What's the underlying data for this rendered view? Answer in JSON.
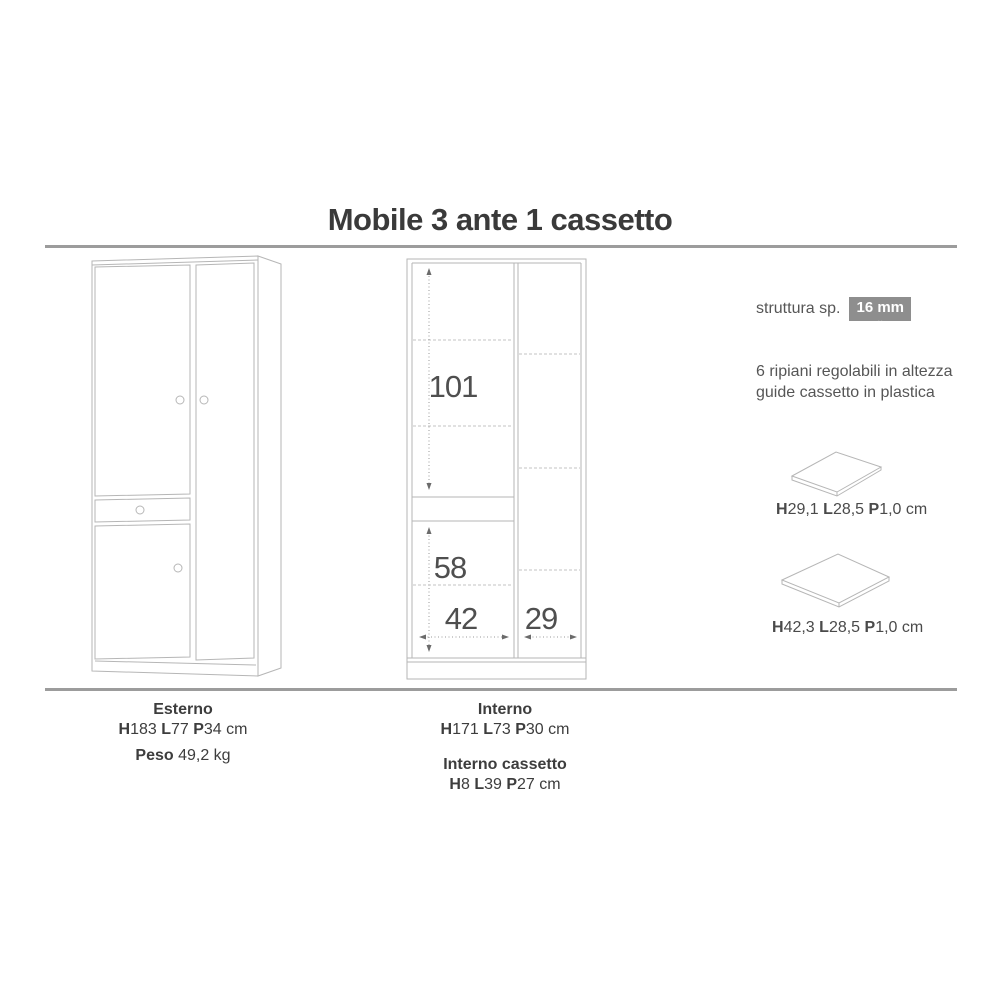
{
  "title": "Mobile 3 ante 1 cassetto",
  "colors": {
    "drawing_line": "#b6b6b6",
    "dimension_text": "#4f4f4f",
    "body_text": "#4a4a4a",
    "badge_bg": "#8e8e8e",
    "rule": "#9c9c9c"
  },
  "spec_panel": {
    "struttura_label": "struttura sp.",
    "struttura_value": "16 mm",
    "notes_line1": "6 ripiani regolabili in altezza",
    "notes_line2": "guide cassetto in plastica",
    "shelf_small_dims": [
      {
        "t": "H",
        "bold": true
      },
      {
        "t": "29,1 "
      },
      {
        "t": "L",
        "bold": true
      },
      {
        "t": "28,5 "
      },
      {
        "t": "P",
        "bold": true
      },
      {
        "t": "1,0 "
      },
      {
        "t": "cm"
      }
    ],
    "shelf_large_dims": [
      {
        "t": "H",
        "bold": true
      },
      {
        "t": "42,3 "
      },
      {
        "t": "L",
        "bold": true
      },
      {
        "t": "28,5 "
      },
      {
        "t": "P",
        "bold": true
      },
      {
        "t": "1,0 "
      },
      {
        "t": "cm"
      }
    ]
  },
  "interior_dims": {
    "upper_height": "101",
    "lower_height": "58",
    "left_width": "42",
    "right_width": "29"
  },
  "footer": {
    "esterno_heading": "Esterno",
    "esterno_dims": [
      {
        "t": "H",
        "bold": true
      },
      {
        "t": "183 "
      },
      {
        "t": "L",
        "bold": true
      },
      {
        "t": "77 "
      },
      {
        "t": "P",
        "bold": true
      },
      {
        "t": "34 "
      },
      {
        "t": "cm"
      }
    ],
    "peso": [
      {
        "t": "Peso ",
        "bold": true
      },
      {
        "t": "49,2 kg"
      }
    ],
    "interno_heading": "Interno",
    "interno_dims": [
      {
        "t": "H",
        "bold": true
      },
      {
        "t": "171 "
      },
      {
        "t": "L",
        "bold": true
      },
      {
        "t": "73 "
      },
      {
        "t": "P",
        "bold": true
      },
      {
        "t": "30 "
      },
      {
        "t": "cm"
      }
    ],
    "cassetto_heading": "Interno cassetto",
    "cassetto_dims": [
      {
        "t": "H",
        "bold": true
      },
      {
        "t": "8 "
      },
      {
        "t": "L",
        "bold": true
      },
      {
        "t": "39 "
      },
      {
        "t": "P",
        "bold": true
      },
      {
        "t": "27 "
      },
      {
        "t": "cm"
      }
    ]
  }
}
